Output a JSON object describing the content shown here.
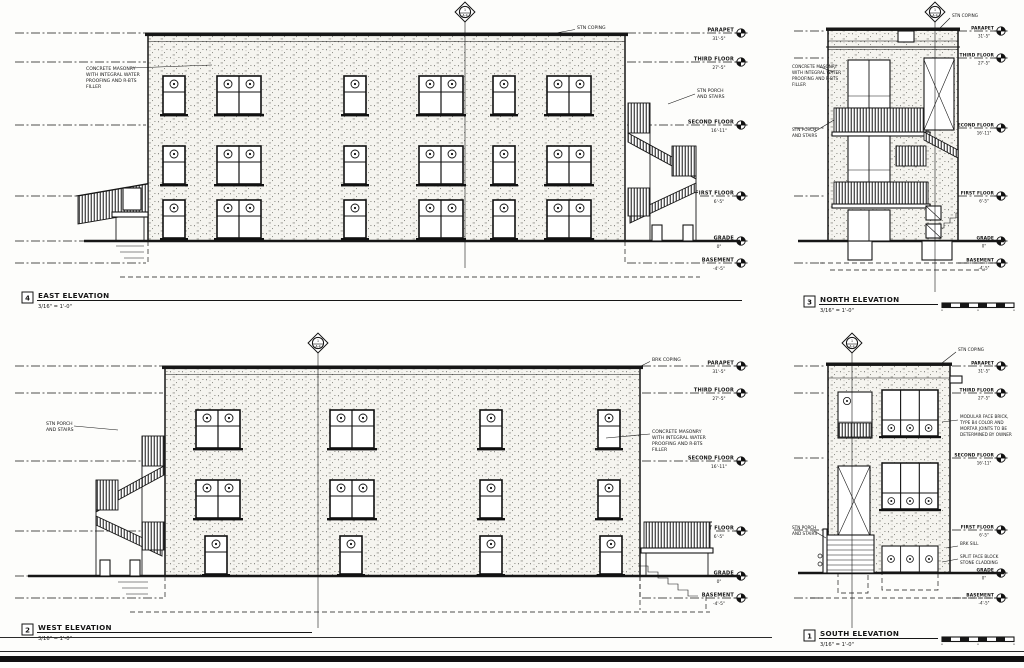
{
  "colors": {
    "ink": "#161616",
    "paper": "#fdfdfb"
  },
  "levels": [
    {
      "label": "PARAPET",
      "value": "31'-5\""
    },
    {
      "label": "THIRD FLOOR",
      "value": "27'-5\""
    },
    {
      "label": "SECOND FLOOR",
      "value": "16'-11\""
    },
    {
      "label": "FIRST FLOOR",
      "value": "6'-5\""
    },
    {
      "label": "GRADE",
      "value": "0\""
    },
    {
      "label": "BASEMENT",
      "value": "-4'-5\""
    }
  ],
  "section_marker": {
    "num": "1",
    "sheet": "A-4"
  },
  "annotations": {
    "masonry": [
      "CONCRETE MASONRY",
      "WITH INTEGRAL WATER",
      "PROOFING AND R-BTS",
      "FILLER"
    ],
    "stn_coping": "STN COPING",
    "brk_coping": "BRK COPING",
    "porch": [
      "STN PORCH",
      "AND STAIRS"
    ],
    "brick": [
      "MODULAR FACE BRICK,",
      "TYPE B4 COLOR AND",
      "MORTAR JOINTS TO BE",
      "DETERMINED BY OWNER"
    ],
    "brk_sill": "BRK SILL",
    "cladding": [
      "SPLIT FACE BLOCK",
      "STONE CLADDING"
    ]
  },
  "titles": {
    "east": {
      "num": "4",
      "title": "EAST ELEVATION",
      "scale": "3/16\" = 1'-0\""
    },
    "north": {
      "num": "3",
      "title": "NORTH ELEVATION",
      "scale": "3/16\" = 1'-0\""
    },
    "west": {
      "num": "2",
      "title": "WEST ELEVATION",
      "scale": "3/16\" = 1'-0\""
    },
    "south": {
      "num": "1",
      "title": "SOUTH ELEVATION",
      "scale": "3/16\" = 1'-0\""
    }
  }
}
